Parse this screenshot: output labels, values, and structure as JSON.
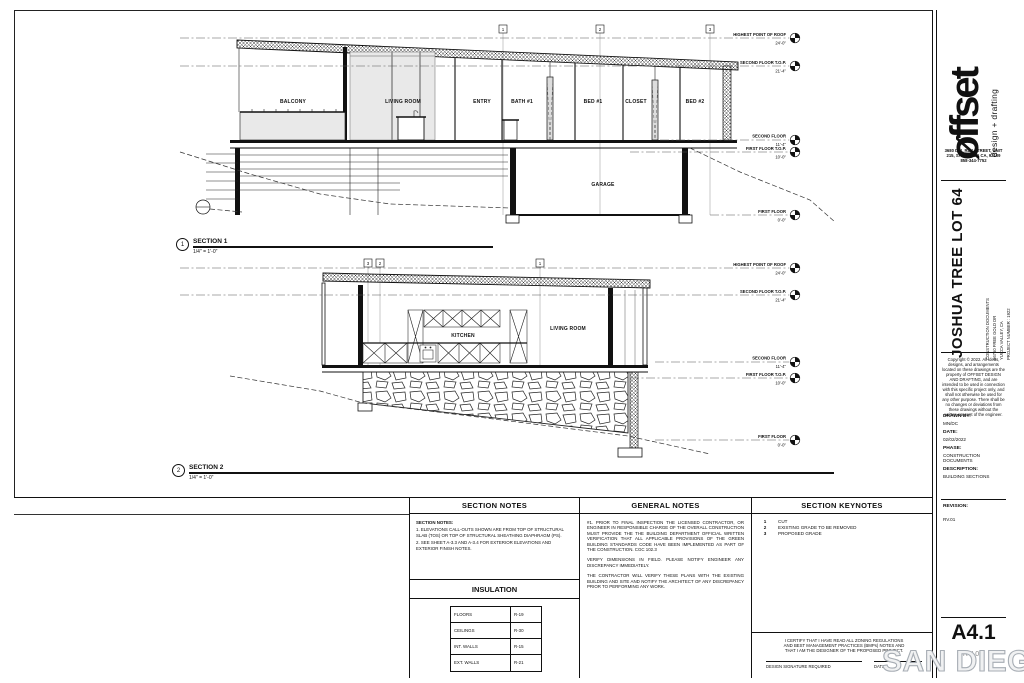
{
  "sheet": {
    "watermark_left": "SAN DIEGO",
    "watermark_right": "MLS"
  },
  "title_block": {
    "logo_name": "øffset",
    "logo_tagline": "design + drafting",
    "address_lines": [
      "3680 DEL REY STREET, UNIT",
      "215, SAN DIEGO CA, 92109",
      "858-344-7752"
    ],
    "project_title": "JOSHUA TREE LOT 64",
    "project_meta": [
      "CONSTRUCTION DOCUMENTS",
      "56760 FREE GOLD DR",
      "YUCCA VALLEY, CA",
      "PROJECT NUMBER : 1922"
    ],
    "copyright": "Copyright © 2022. All ideas, designs, and arrangements located on these drawings are the property of OFFSET DESIGN AND DRAFTING, and are intended to be used in connection with this specific project only, and shall not otherwise be used for any other purpose. There shall be no changes or deviations from these drawings without the written consent of the engineer.",
    "fields": [
      {
        "label": "DRAWN BY:",
        "value": "MN/DC"
      },
      {
        "label": "DATE:",
        "value": "02/02/2022"
      },
      {
        "label": "PHASE:",
        "value": "CONSTRUCTION DOCUMENTS"
      },
      {
        "label": "DESCRIPTION:",
        "value": "BUILDING SECTIONS"
      }
    ],
    "revision_label": "REVISION:",
    "revision_value": "RV.01",
    "sheet_number": "A4.1",
    "sheet_revision": "RV.01"
  },
  "section1": {
    "number": "1",
    "title": "SECTION 1",
    "scale": "1/4\" = 1'-0\"",
    "grid_bubbles": [
      "1",
      "2",
      "3"
    ],
    "rooms": {
      "balcony": "BALCONY",
      "living_room": "LIVING ROOM",
      "entry": "ENTRY",
      "bath1": "BATH #1",
      "bed1": "BED #1",
      "closet": "CLOSET",
      "bed2": "BED #2",
      "garage": "GARAGE"
    },
    "levels": [
      {
        "label": "HIGHEST POINT OF ROOF",
        "value": "24'-0\""
      },
      {
        "label": "SECOND FLOOR T.O.P.",
        "value": "21'-4\""
      },
      {
        "label": "SECOND FLOOR",
        "value": "11'-4\""
      },
      {
        "label": "FIRST FLOOR T.O.P.",
        "value": "10'-0\""
      },
      {
        "label": "FIRST FLOOR",
        "value": "0'-0\""
      }
    ]
  },
  "section2": {
    "number": "2",
    "title": "SECTION 2",
    "scale": "1/4\" = 1'-0\"",
    "grid_bubbles": [
      "3",
      "2",
      "1"
    ],
    "rooms": {
      "kitchen": "KITCHEN",
      "living_room": "LIVING ROOM"
    },
    "levels": [
      {
        "label": "HIGHEST POINT OF ROOF",
        "value": "24'-0\""
      },
      {
        "label": "SECOND FLOOR T.O.P.",
        "value": "21'-4\""
      },
      {
        "label": "SECOND FLOOR",
        "value": "11'-4\""
      },
      {
        "label": "FIRST FLOOR T.O.P.",
        "value": "10'-0\""
      },
      {
        "label": "FIRST FLOOR",
        "value": "0'-0\""
      }
    ]
  },
  "notes": {
    "section_notes": {
      "header": "SECTION NOTES",
      "title": "SECTION NOTES:",
      "items": [
        "1. ELEVATIONS CALL-OUTS SHOWN ARE FROM TOP OF STRUCTURAL SLAB (TOS) OR TOP OF STRUCTURAL SHEATHING DIAPHRAGM (PS).",
        "2. SEE SHEET A-3.3 AND A-3.4 FOR EXTERIOR ELEVATIONS AND EXTERIOR FINISH NOTES."
      ]
    },
    "insulation": {
      "header": "INSULATION",
      "rows": [
        [
          "FLOORS",
          "R-19"
        ],
        [
          "CEILINGS",
          "R-30"
        ],
        [
          "INT. WALLS",
          "R-15"
        ],
        [
          "EXT. WALLS",
          "R-21"
        ]
      ]
    },
    "general_notes": {
      "header": "GENERAL NOTES",
      "paragraphs": [
        "#1. PRIOR TO FINAL INSPECTION THE LICENSED CONTRACTOR, OR ENGINEER IN RESPONSIBLE CHARGE OF THE OVERALL CONSTRUCTION MUST PROVIDE THE THE BUILDING DEPARTMENT OFFICIAL WRITTEN VERIFICATION THAT ALL APPLICABLE PROVISIONS OF THE GREEN BUILDING STANDARDS CODE HAVE BEEN IMPLEMENTED AS PART OF THE CONSTRUCTION. CGC 102.3",
        "VERIFY DIMENSIONS IN FIELD. PLEASE NOTIFY ENGINEER ANY DISCREPANCY IMMEDIATELY.",
        "THE CONTRACTOR WILL VERIFY THESE PLANS WITH THE EXISTING BUILDING AND SITE AND NOTIFY THE ARCHITECT OF ANY DISCREPANCY PRIOR TO PERFORMING ANY WORK."
      ]
    },
    "section_keynotes": {
      "header": "SECTION KEYNOTES",
      "items": [
        {
          "num": "1",
          "text": "CUT"
        },
        {
          "num": "2",
          "text": "EXISTING GRADE TO BE REMOVED"
        },
        {
          "num": "3",
          "text": "PROPOSED GRADE"
        }
      ]
    },
    "certification": {
      "text": "I CERTIFY THAT I HAVE READ ALL ZONING REGULATIONS AND BEST MANAGEMENT PRACTICES (BMPs) NOTES AND THAT I AM THE DESIGNER OF THE PROPOSED PROJECT.",
      "signature_label": "DESIGN SIGNATURE REQUIRED",
      "date_label": "DATE"
    }
  }
}
